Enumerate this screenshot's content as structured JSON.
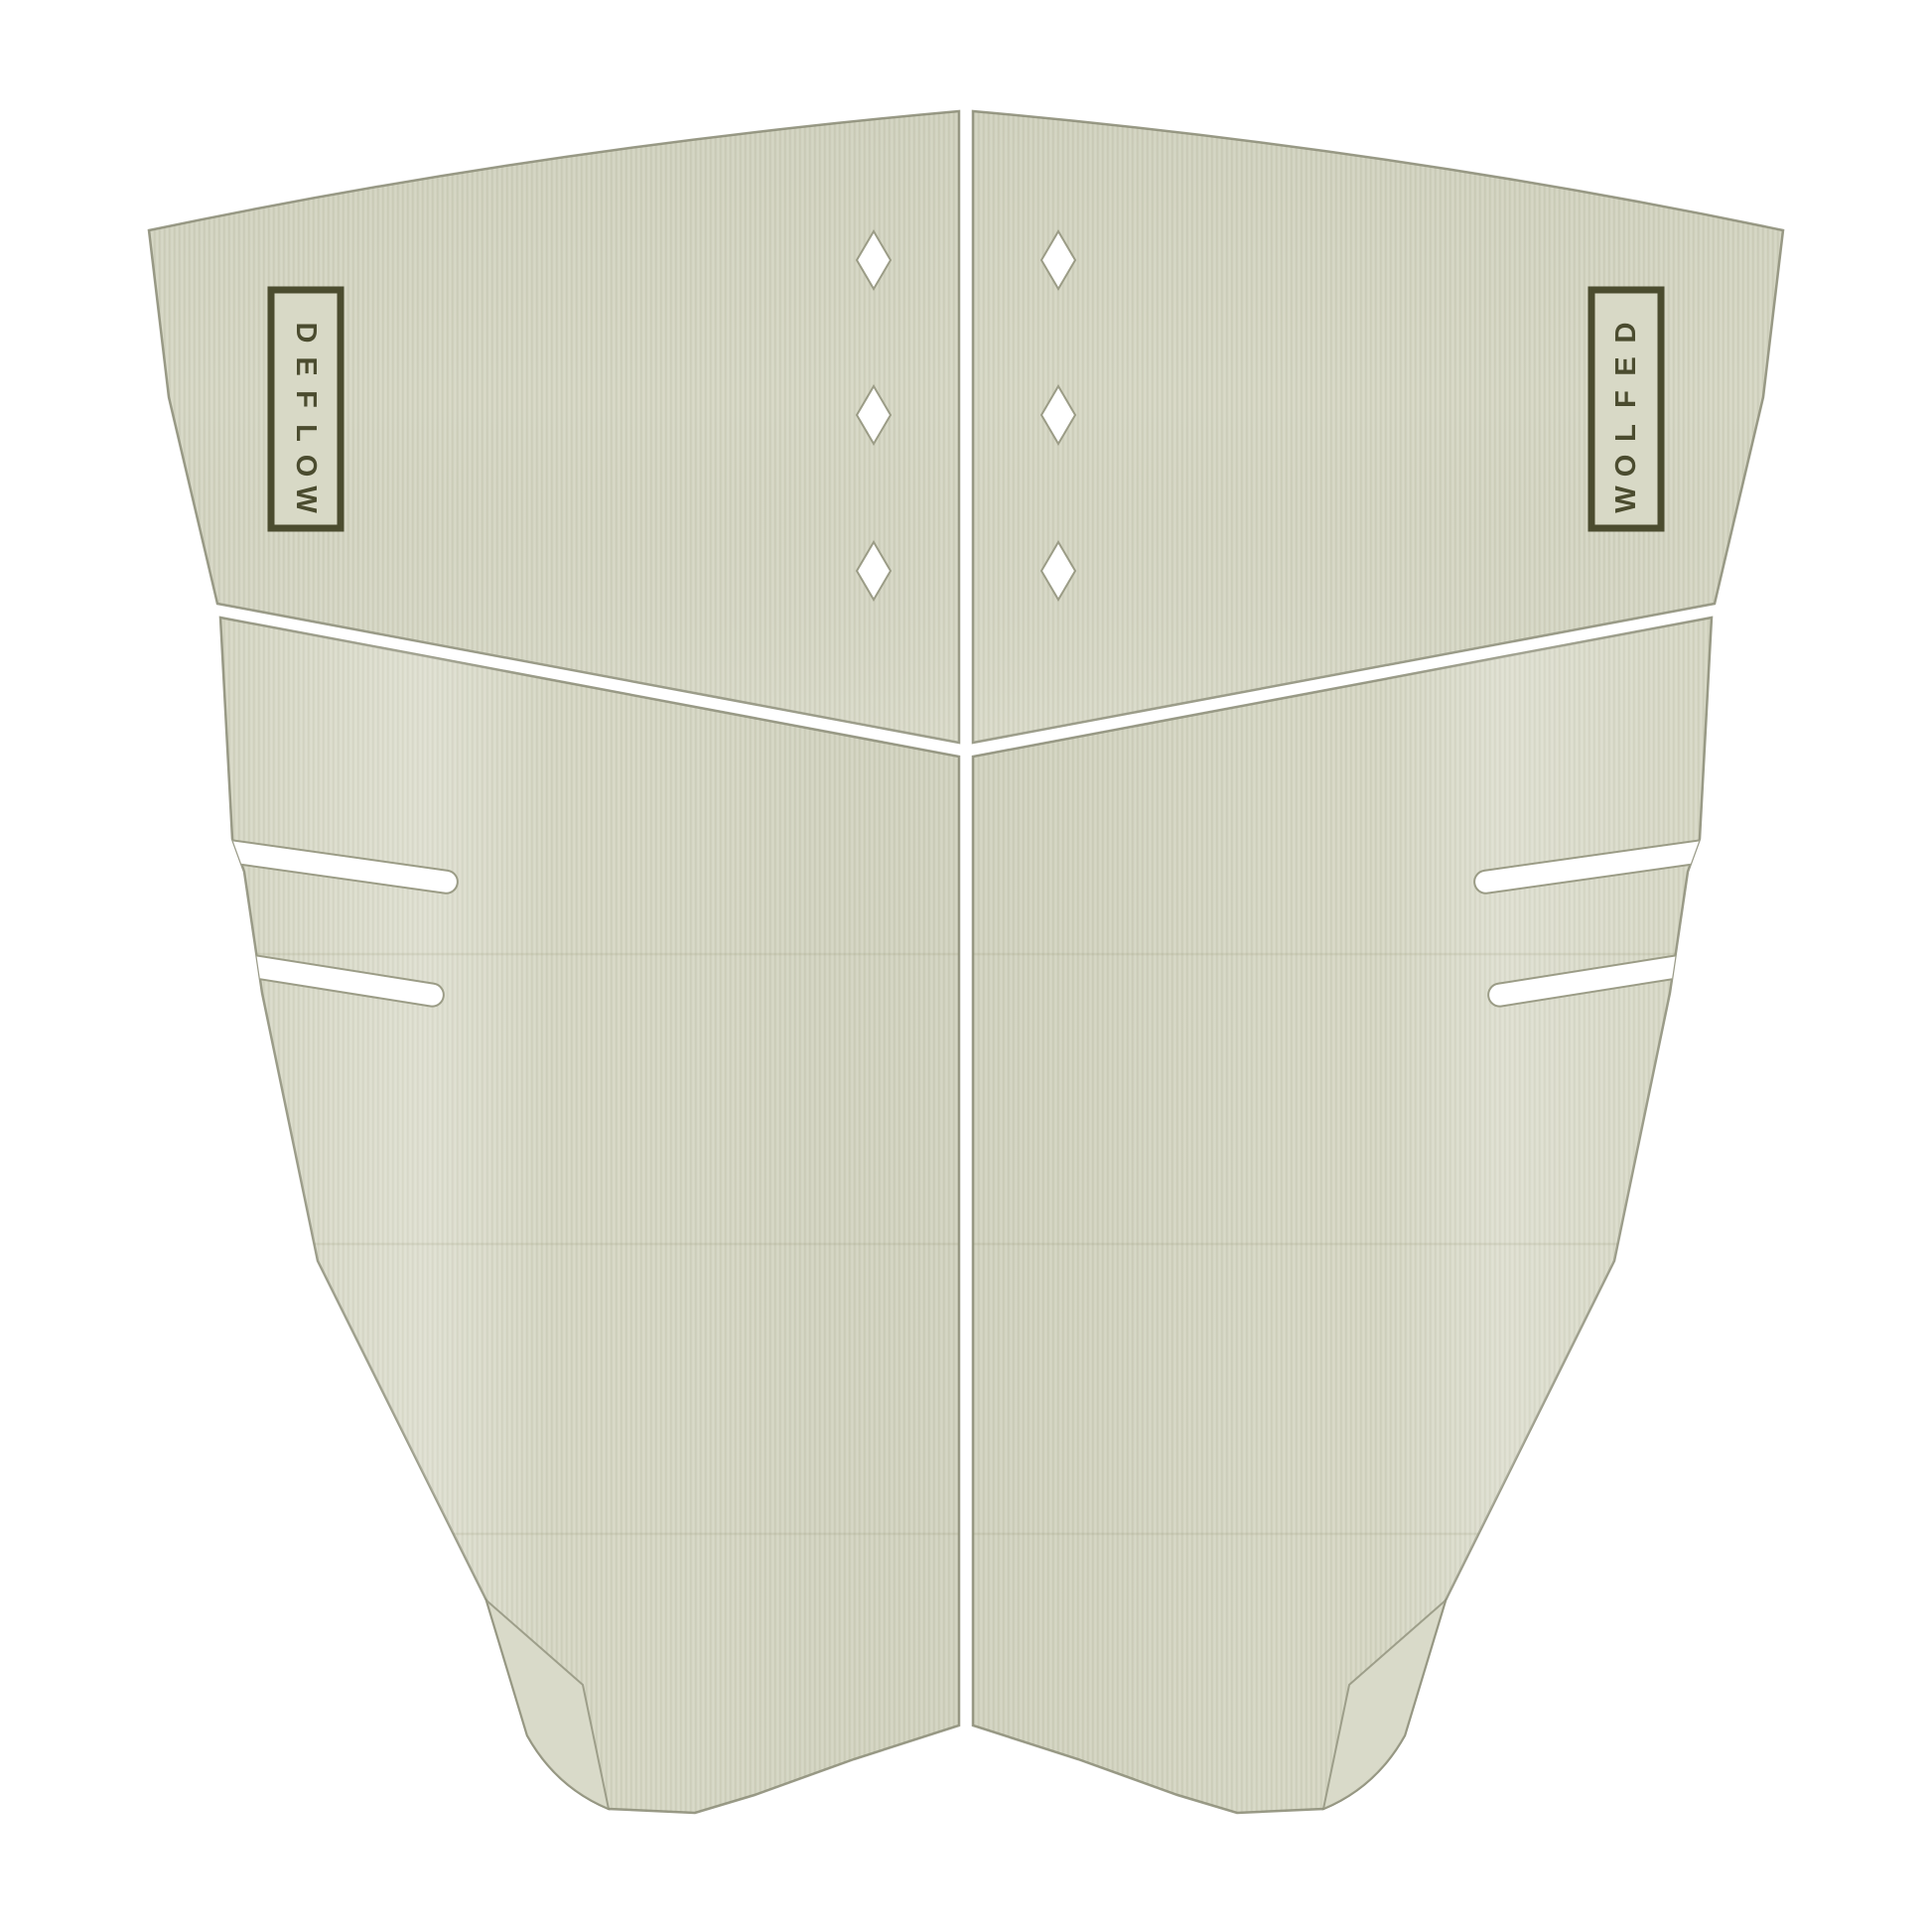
{
  "brand": {
    "name": "DEFLOW"
  },
  "logos": {
    "text": "DEFLOW",
    "letters": [
      "D",
      "E",
      "F",
      "L",
      "O",
      "W"
    ],
    "count": 2
  },
  "pad": {
    "panels": 4,
    "diamond_cutouts_per_panel": 3,
    "diamond_cutouts_total": 6,
    "side_slits_per_side": 2,
    "tail_kick_corners": 2
  },
  "colors": {
    "background": "#ffffff",
    "pad": "#d5d6c4",
    "stripe_dark": "#cdceba",
    "stripe_light": "#dbdcca",
    "pad_light": "#d8d9c6",
    "wedge": "#d9dac9",
    "outline": "#8f907b",
    "cutout_outline": "#9b9c86",
    "logo_olive": "#4b4c2f"
  }
}
